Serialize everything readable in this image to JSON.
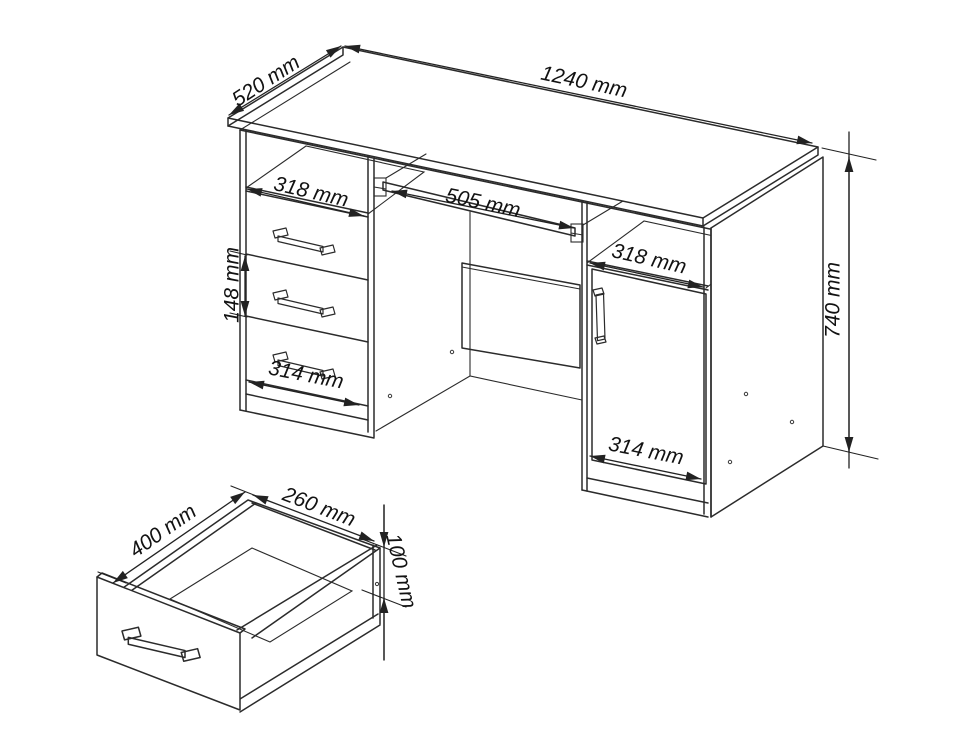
{
  "colors": {
    "background": "#ffffff",
    "line": "#2b2b2b",
    "dimension_line": "#222222",
    "text": "#121212"
  },
  "unit": "mm",
  "desk": {
    "top_length": "1240 mm",
    "top_depth": "520 mm",
    "overall_height": "740 mm",
    "left_shelf_width": "318 mm",
    "tray_width": "505 mm",
    "drawer_height": "148 mm",
    "left_drawer_width": "314 mm",
    "right_shelf_width": "318 mm",
    "door_width": "314 mm"
  },
  "drawer_detail": {
    "depth": "400 mm",
    "width": "260 mm",
    "height": "100 mm"
  }
}
